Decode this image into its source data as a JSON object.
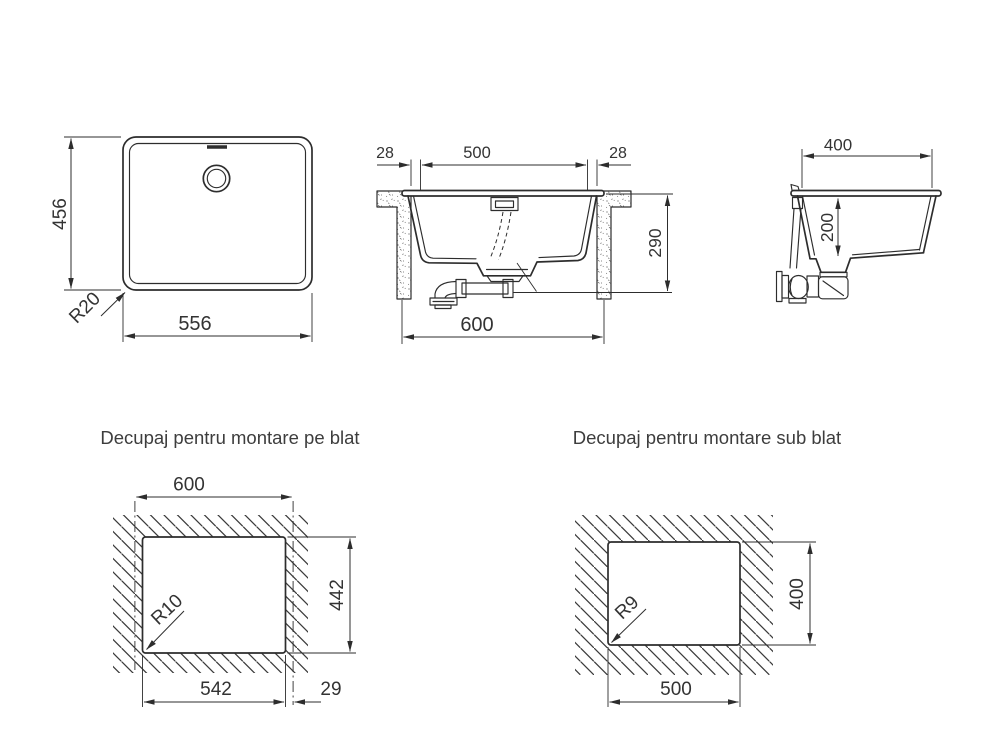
{
  "titles": {
    "topmount": "Decupaj pentru montare pe blat",
    "undermount": "Decupaj pentru montare sub blat"
  },
  "plan_view": {
    "height": "456",
    "width": "556",
    "corner_radius": "R20"
  },
  "front_section": {
    "left_edge": "28",
    "bowl_width": "500",
    "right_edge": "28",
    "total_height": "290",
    "overall_width": "600"
  },
  "side_section": {
    "bowl_length": "400",
    "bowl_depth": "200"
  },
  "topmount_cutout": {
    "sink_width": "600",
    "cutout_height": "442",
    "corner_radius": "R10",
    "cutout_width": "542",
    "side_offset": "29"
  },
  "undermount_cutout": {
    "cutout_width": "500",
    "cutout_height": "400",
    "corner_radius": "R9"
  },
  "colors": {
    "line": "#2d2d2d",
    "text": "#333333",
    "title_text": "#3d3d3d",
    "background": "#ffffff",
    "hatch": "#3a3a3a",
    "speckle": "#6a6a6a"
  }
}
